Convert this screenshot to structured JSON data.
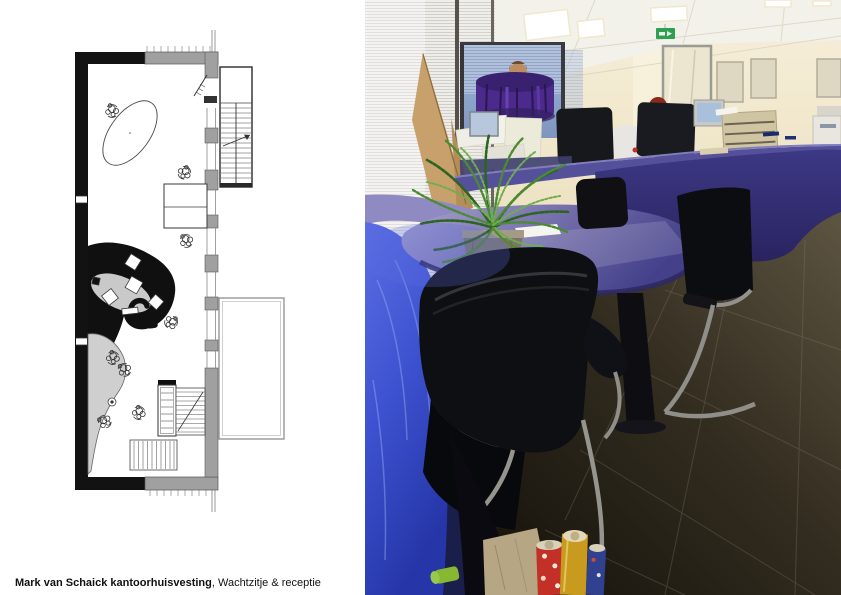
{
  "caption": {
    "project_bold": "Mark van Schaick kantoorhuisvesting",
    "subtitle_rest": ", Wachtzitje & receptie"
  },
  "palette": {
    "plan_black": "#121212",
    "plan_wall_gray": "#a0a0a0",
    "plan_fill_gray": "#c9c9c9",
    "counter_navy": "#34306f",
    "counter_top": "#55509a",
    "table_lavender": "#9b95c8",
    "desk_bright_blue": "#4256d2",
    "fern_green": "#4c8a33",
    "binder_purple": "#4b2a8c",
    "exit_sign_green": "#2fa050",
    "wall_cream": "#efe6cb",
    "floor_dark": "#171309"
  }
}
